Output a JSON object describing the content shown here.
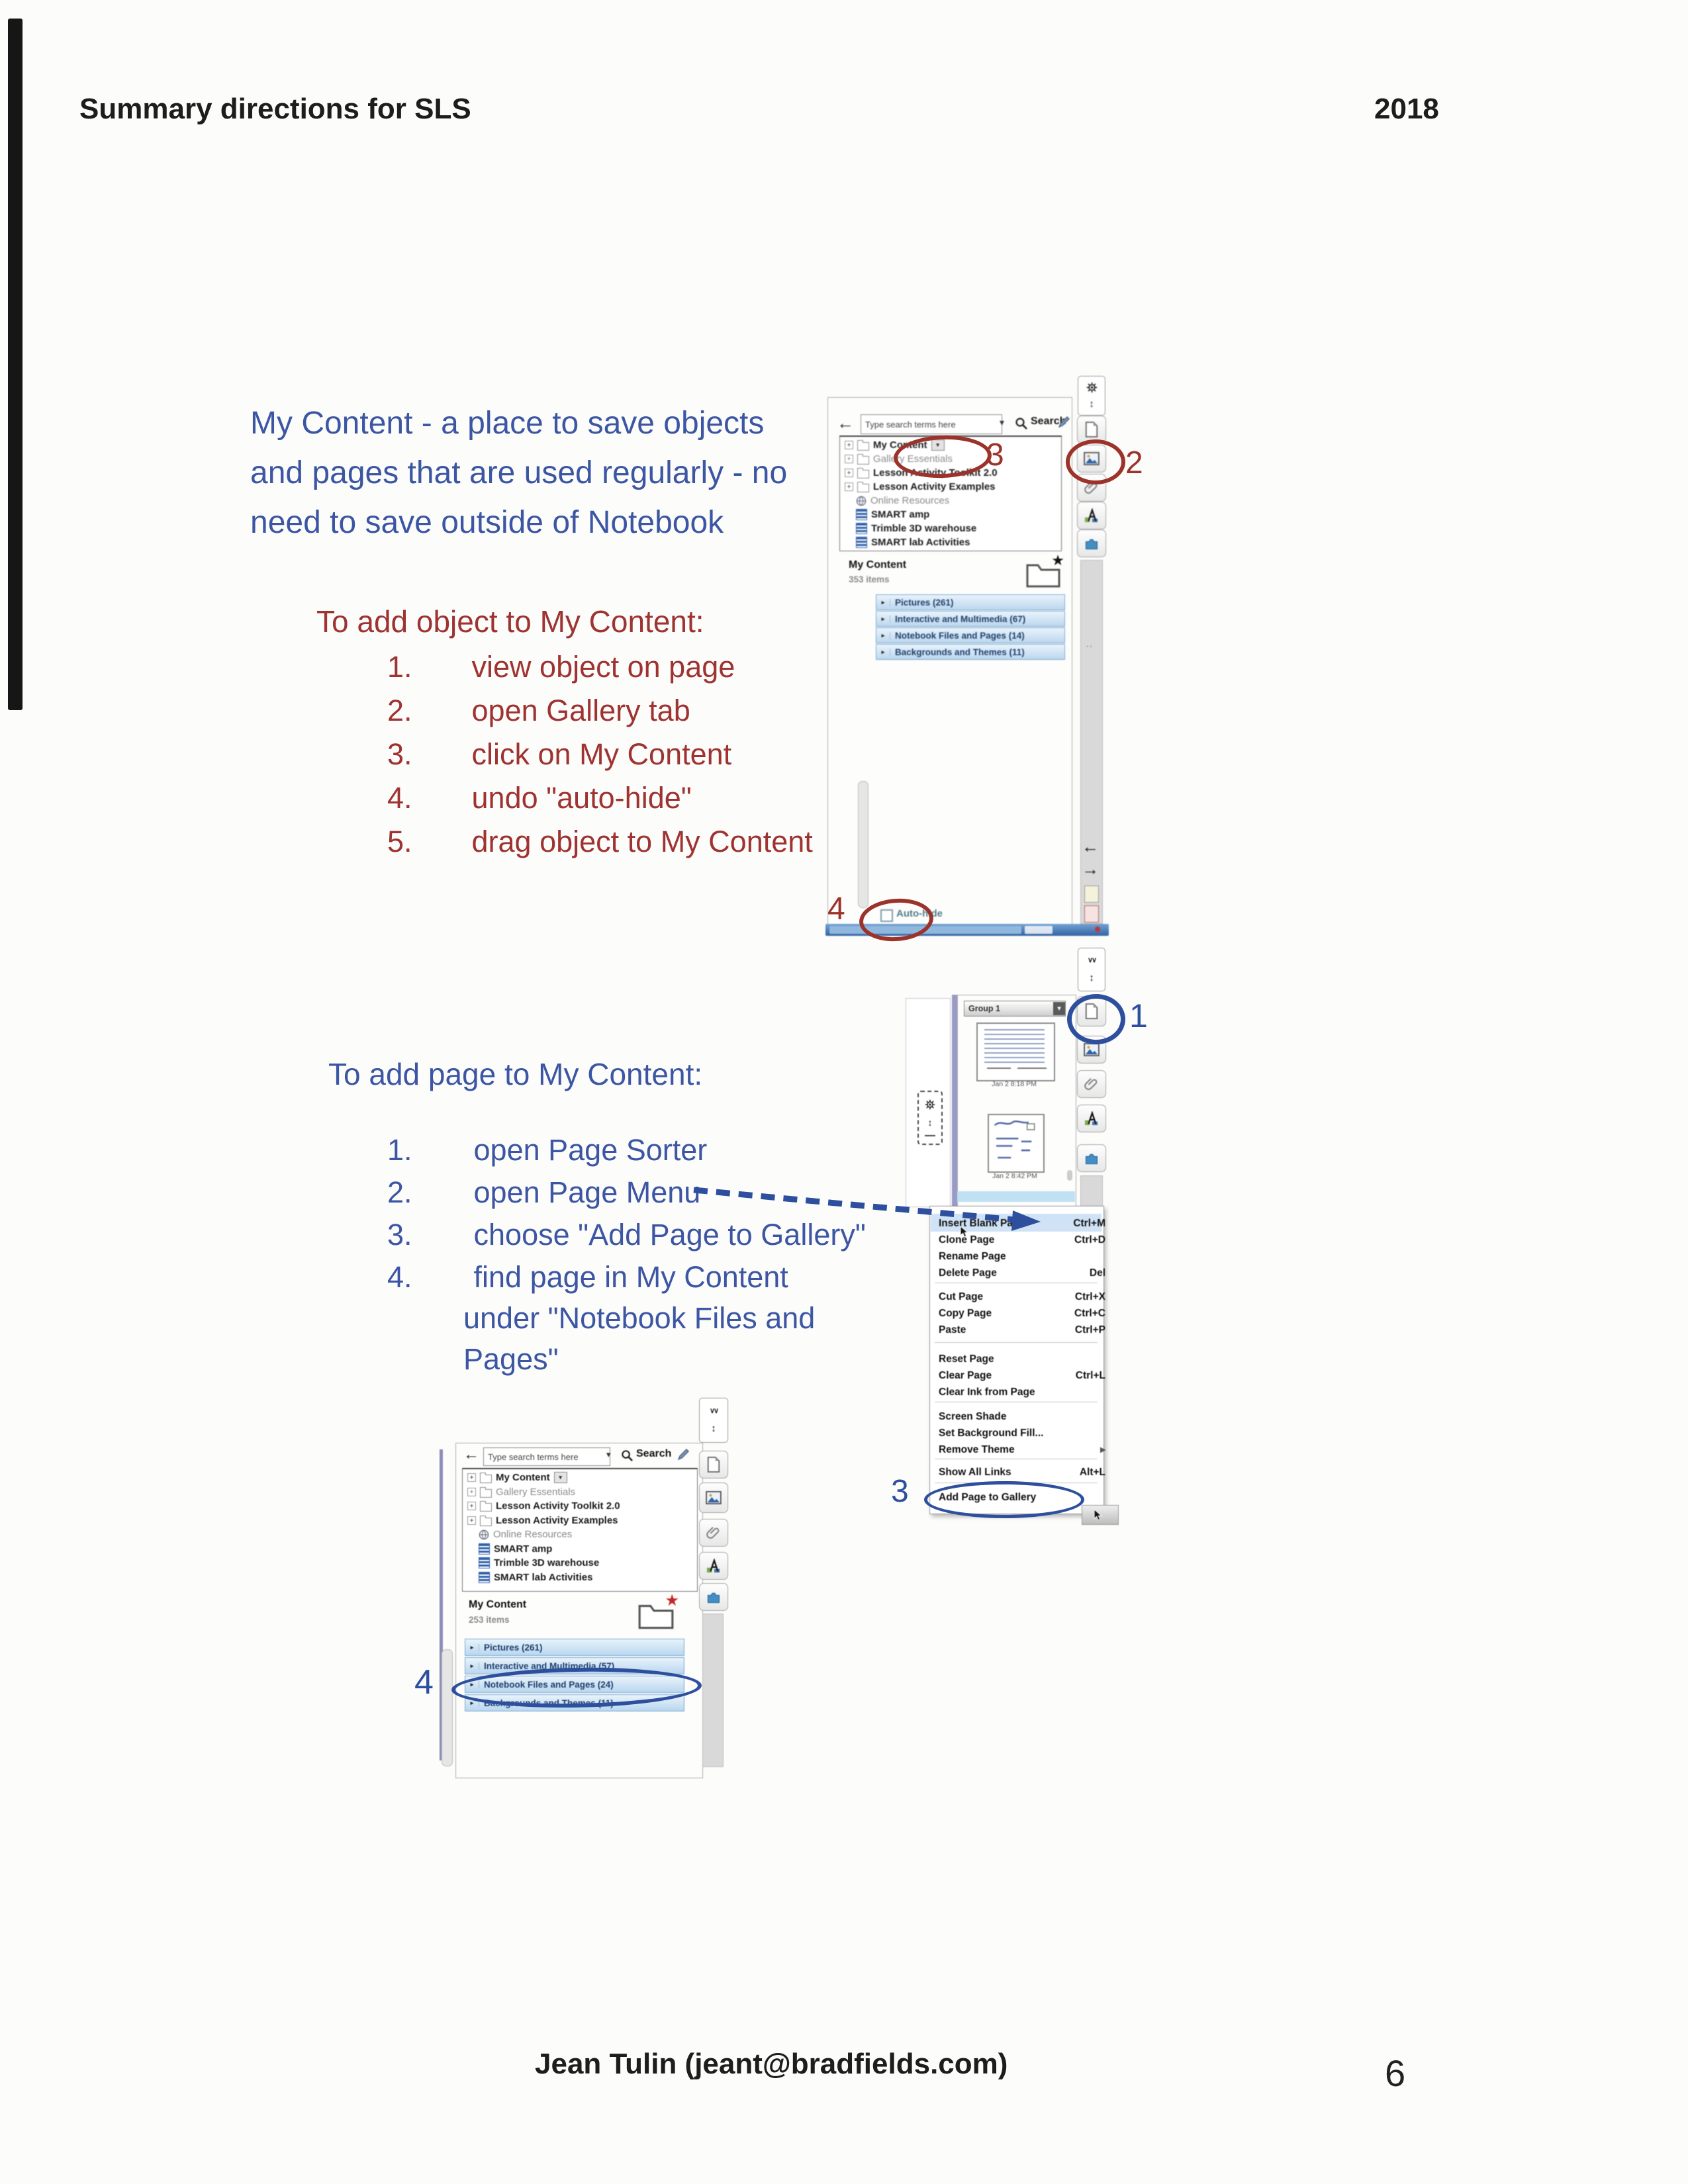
{
  "page": {
    "header_title": "Summary directions for SLS",
    "header_year": "2018",
    "footer_name": "Jean Tulin (jeant@bradfields.com)",
    "page_number": "6"
  },
  "intro_lines": [
    "My Content - a place to save objects",
    "and pages that are used regularly - no",
    "need to save outside of Notebook"
  ],
  "add_object": {
    "heading": "To add object to My Content:",
    "steps": [
      {
        "num": "1.",
        "text": "view object on page"
      },
      {
        "num": "2.",
        "text": "open Gallery tab"
      },
      {
        "num": "3.",
        "text": "click on My Content"
      },
      {
        "num": "4.",
        "text": "undo \"auto-hide\""
      },
      {
        "num": "5.",
        "text": "drag object to My Content"
      }
    ]
  },
  "add_page": {
    "heading": "To add page to My Content:",
    "steps": [
      {
        "num": "1.",
        "line1": "open Page Sorter",
        "line2": "",
        "line3": ""
      },
      {
        "num": "2.",
        "line1": "open Page Menu",
        "line2": "",
        "line3": ""
      },
      {
        "num": "3.",
        "line1": "choose \"Add Page to Gallery\"",
        "line2": "",
        "line3": ""
      },
      {
        "num": "4.",
        "line1": "find page in My Content",
        "line2": "under \"Notebook Files and",
        "line3": "Pages\""
      }
    ]
  },
  "annotations": {
    "gallery_tab_step": "2",
    "my_content_step": "3",
    "autohide_step": "4",
    "page_sorter_step": "1",
    "menu_step": "3",
    "category_step": "4"
  },
  "gallery_search": {
    "placeholder": "Type search terms here",
    "search_label": "Search"
  },
  "shot1": {
    "tree": [
      "My Content",
      "Gallery Essentials",
      "Lesson Activity Toolkit 2.0",
      "Lesson Activity Examples",
      "Online Resources",
      "SMART amp",
      "Trimble 3D warehouse",
      "SMART lab Activities"
    ],
    "panel_title": "My Content",
    "panel_count": "353 items",
    "categories": [
      "Pictures (261)",
      "Interactive and Multimedia (67)",
      "Notebook Files and Pages (14)",
      "Backgrounds and Themes (11)"
    ],
    "autohide_label": "Auto-hide"
  },
  "shot2": {
    "group_label": "Group 1",
    "thumb1_caption": "Jan 2 8:18 PM",
    "thumb2_caption": "Jan 2 8:42 PM"
  },
  "page_menu": {
    "items": [
      {
        "label": "Insert Blank Page",
        "shortcut": "Ctrl+M"
      },
      {
        "label": "Clone Page",
        "shortcut": "Ctrl+D"
      },
      {
        "label": "Rename Page",
        "shortcut": ""
      },
      {
        "label": "Delete Page",
        "shortcut": "Del"
      },
      {
        "label": "Cut Page",
        "shortcut": "Ctrl+X"
      },
      {
        "label": "Copy Page",
        "shortcut": "Ctrl+C"
      },
      {
        "label": "Paste",
        "shortcut": "Ctrl+P"
      },
      {
        "label": "Reset Page",
        "shortcut": ""
      },
      {
        "label": "Clear Page",
        "shortcut": "Ctrl+L"
      },
      {
        "label": "Clear Ink from Page",
        "shortcut": ""
      },
      {
        "label": "Screen Shade",
        "shortcut": ""
      },
      {
        "label": "Set Background Fill...",
        "shortcut": ""
      },
      {
        "label": "Remove Theme",
        "shortcut": ""
      },
      {
        "label": "Show All Links",
        "shortcut": "Alt+L"
      },
      {
        "label": "Add Page to Gallery",
        "shortcut": ""
      }
    ]
  },
  "shot3": {
    "tree": [
      "My Content",
      "Gallery Essentials",
      "Lesson Activity Toolkit 2.0",
      "Lesson Activity Examples",
      "Online Resources",
      "SMART amp",
      "Trimble 3D warehouse",
      "SMART lab Activities"
    ],
    "panel_title": "My Content",
    "panel_count": "253 items",
    "categories": [
      "Pictures (261)",
      "Interactive and Multimedia (57)",
      "Notebook Files and Pages (24)",
      "Backgrounds and Themes (11)"
    ]
  },
  "icons": {
    "plus": "+",
    "caret_down": "▾",
    "play": "▸",
    "arrow_left": "←",
    "arrow_right": "→",
    "updown": "↕",
    "collapse": "∨∨",
    "dots": "··",
    "star": "★"
  },
  "colors": {
    "handout_blue": "#3c56a4",
    "handout_red": "#9e3331",
    "annotation_red": "#9c332b",
    "annotation_blue": "#2d4f9e"
  }
}
